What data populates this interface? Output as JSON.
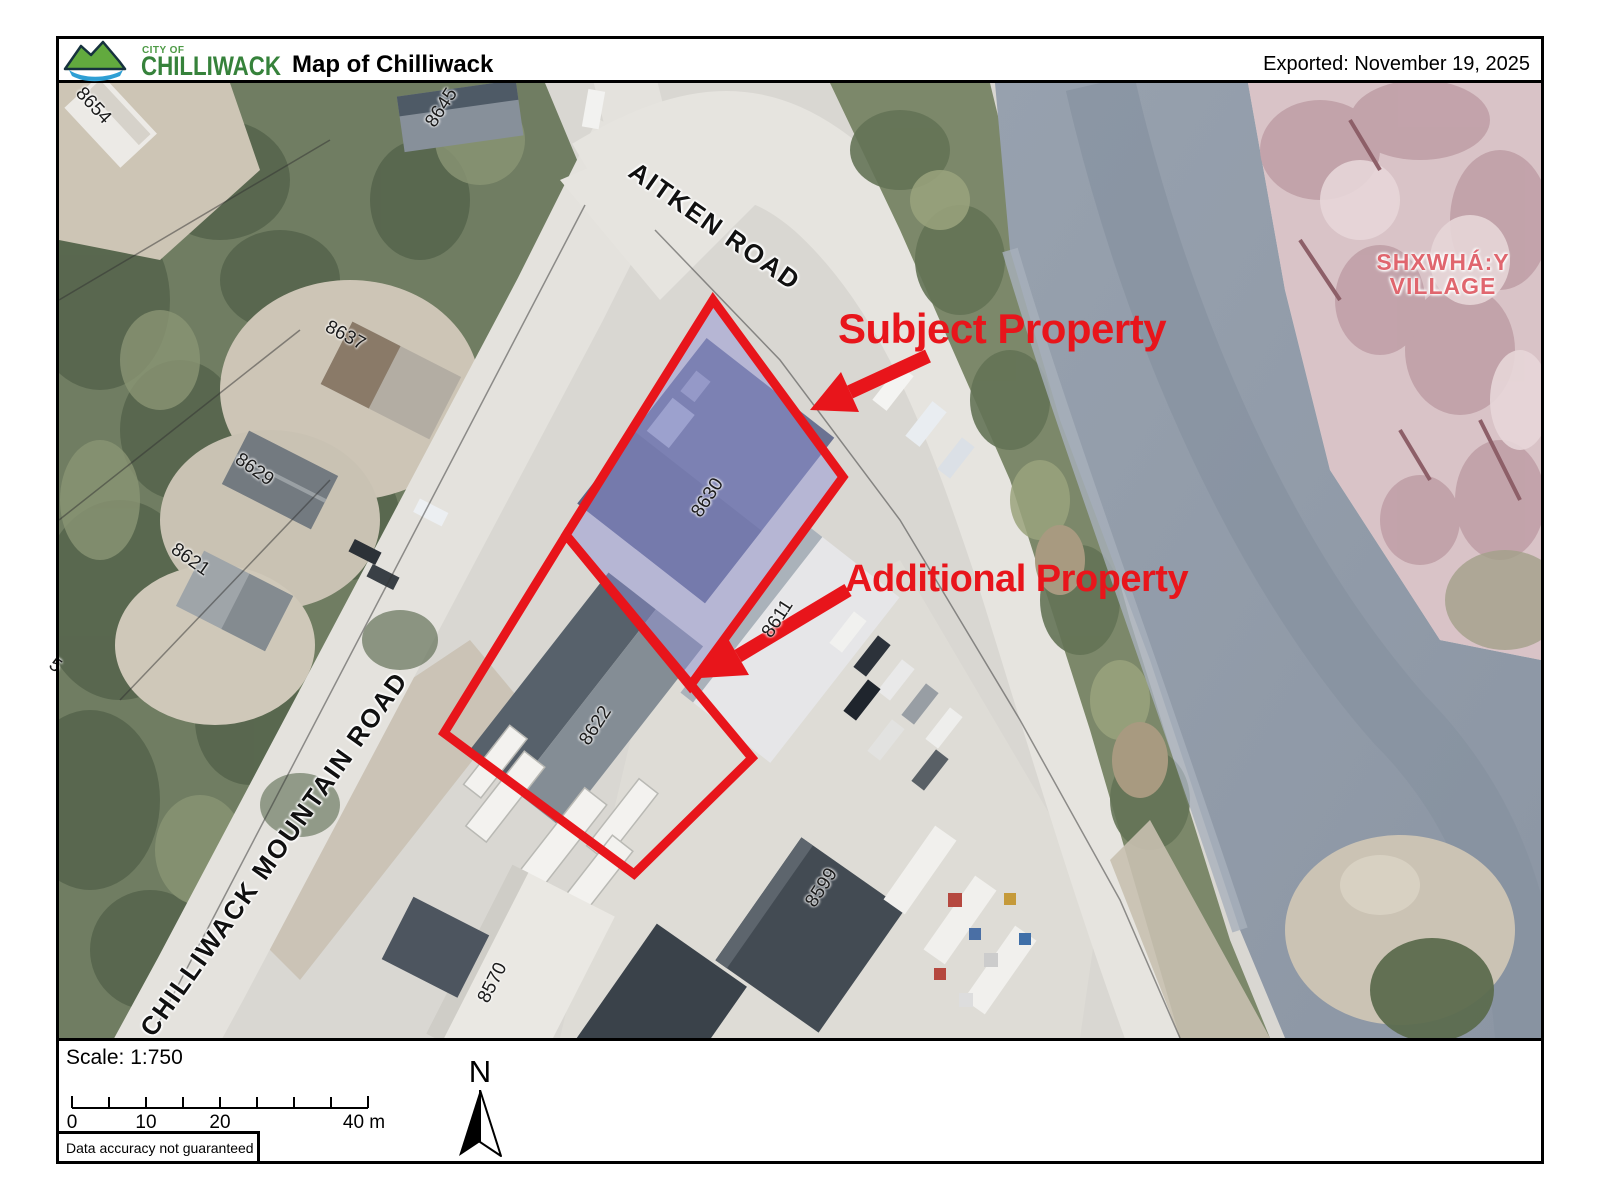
{
  "header": {
    "logo_small": "CITY OF",
    "logo_name": "CHILLIWACK",
    "title": "Map of Chilliwack",
    "exported": "Exported: November 19, 2025"
  },
  "map": {
    "road_labels": [
      {
        "text": "AITKEN ROAD",
        "x": 632,
        "y": 168,
        "rot": 35
      },
      {
        "text": "CHILLIWACK MOUNTAIN ROAD",
        "x": 146,
        "y": 1033,
        "rot": -54.5
      }
    ],
    "parcel_labels": [
      {
        "text": "8654",
        "x": 93,
        "y": 106,
        "rot": 47
      },
      {
        "text": "8645",
        "x": 442,
        "y": 108,
        "rot": -57
      },
      {
        "text": "8637",
        "x": 345,
        "y": 336,
        "rot": 28
      },
      {
        "text": "8629",
        "x": 254,
        "y": 470,
        "rot": 35
      },
      {
        "text": "8621",
        "x": 190,
        "y": 560,
        "rot": 35
      },
      {
        "text": "8630",
        "x": 708,
        "y": 498,
        "rot": -57
      },
      {
        "text": "8622",
        "x": 596,
        "y": 726,
        "rot": -57
      },
      {
        "text": "8611",
        "x": 778,
        "y": 619,
        "rot": -57
      },
      {
        "text": "8599",
        "x": 822,
        "y": 888,
        "rot": -57
      },
      {
        "text": "8570",
        "x": 493,
        "y": 983,
        "rot": -63
      },
      {
        "text": "5",
        "x": 55,
        "y": 666,
        "rot": 35
      }
    ],
    "annotations": [
      {
        "label": "Subject Property",
        "x": 838,
        "y": 305,
        "size": 42
      },
      {
        "label": "Additional Property",
        "x": 845,
        "y": 558,
        "size": 38
      }
    ],
    "village": {
      "line1": "SHXWHÁ:Y",
      "line2": "VILLAGE",
      "x": 1443,
      "y": 250
    }
  },
  "footer": {
    "scale_label": "Scale: 1:750",
    "scale_ticks": [
      {
        "text": "0",
        "x": 72
      },
      {
        "text": "10",
        "x": 146
      },
      {
        "text": "20",
        "x": 220
      },
      {
        "text": "40 m",
        "x": 364
      }
    ],
    "north_label": "N",
    "disclaimer": "Data accuracy not guaranteed"
  },
  "colors": {
    "annotation_red": "#e8151b",
    "village_pink": "#e0666e",
    "subject_fill": "rgba(145,147,216,0.48)",
    "header_green": "#36823b"
  }
}
